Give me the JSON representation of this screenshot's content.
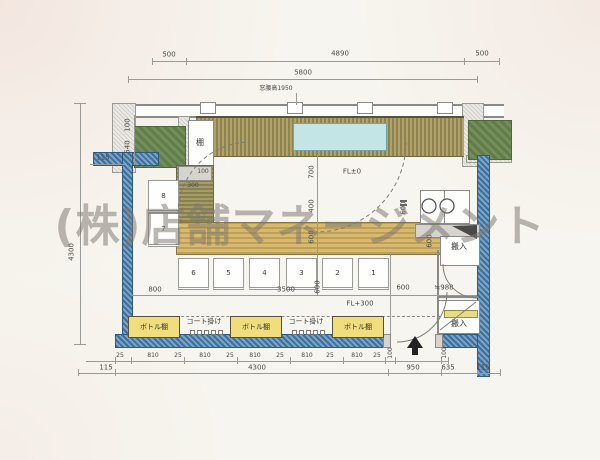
{
  "watermark": "(株)店舗マネージメント",
  "top": {
    "left": "500",
    "mid": "4890",
    "right": "500",
    "total": "5800",
    "window_note": "窓腰高1950"
  },
  "left": {
    "a115": "115",
    "a100": "100",
    "a540": "540",
    "a4300": "4300"
  },
  "mid": {
    "fl0": "FL±0",
    "fl300": "FL+300",
    "d700": "700",
    "d400": "400",
    "d600_counter": "600",
    "d600_pass": "600",
    "d600_kitchen": "600",
    "d100_corner": "100",
    "d300_corner": "300",
    "d800": "800",
    "d3500": "3500",
    "d600_seat": "600",
    "d600_entry": "600",
    "d988": "≒988",
    "shelf": "棚",
    "carry_in_top": "搬入",
    "carry_in_bottom": "搬入"
  },
  "seats": {
    "s8": "8",
    "s7": "7",
    "s6": "6",
    "s5": "5",
    "s4": "4",
    "s3": "3",
    "s2": "2",
    "s1": "1"
  },
  "fixtures": {
    "bottle": "ボトル棚",
    "coat": "コート掛け"
  },
  "b1": [
    "25",
    "810",
    "25",
    "810",
    "25",
    "810",
    "25",
    "810",
    "25",
    "810",
    "25",
    "100",
    "100"
  ],
  "b2": {
    "l115": "115",
    "c4300": "4300",
    "e950": "950",
    "e635": "635",
    "r115": "115"
  }
}
